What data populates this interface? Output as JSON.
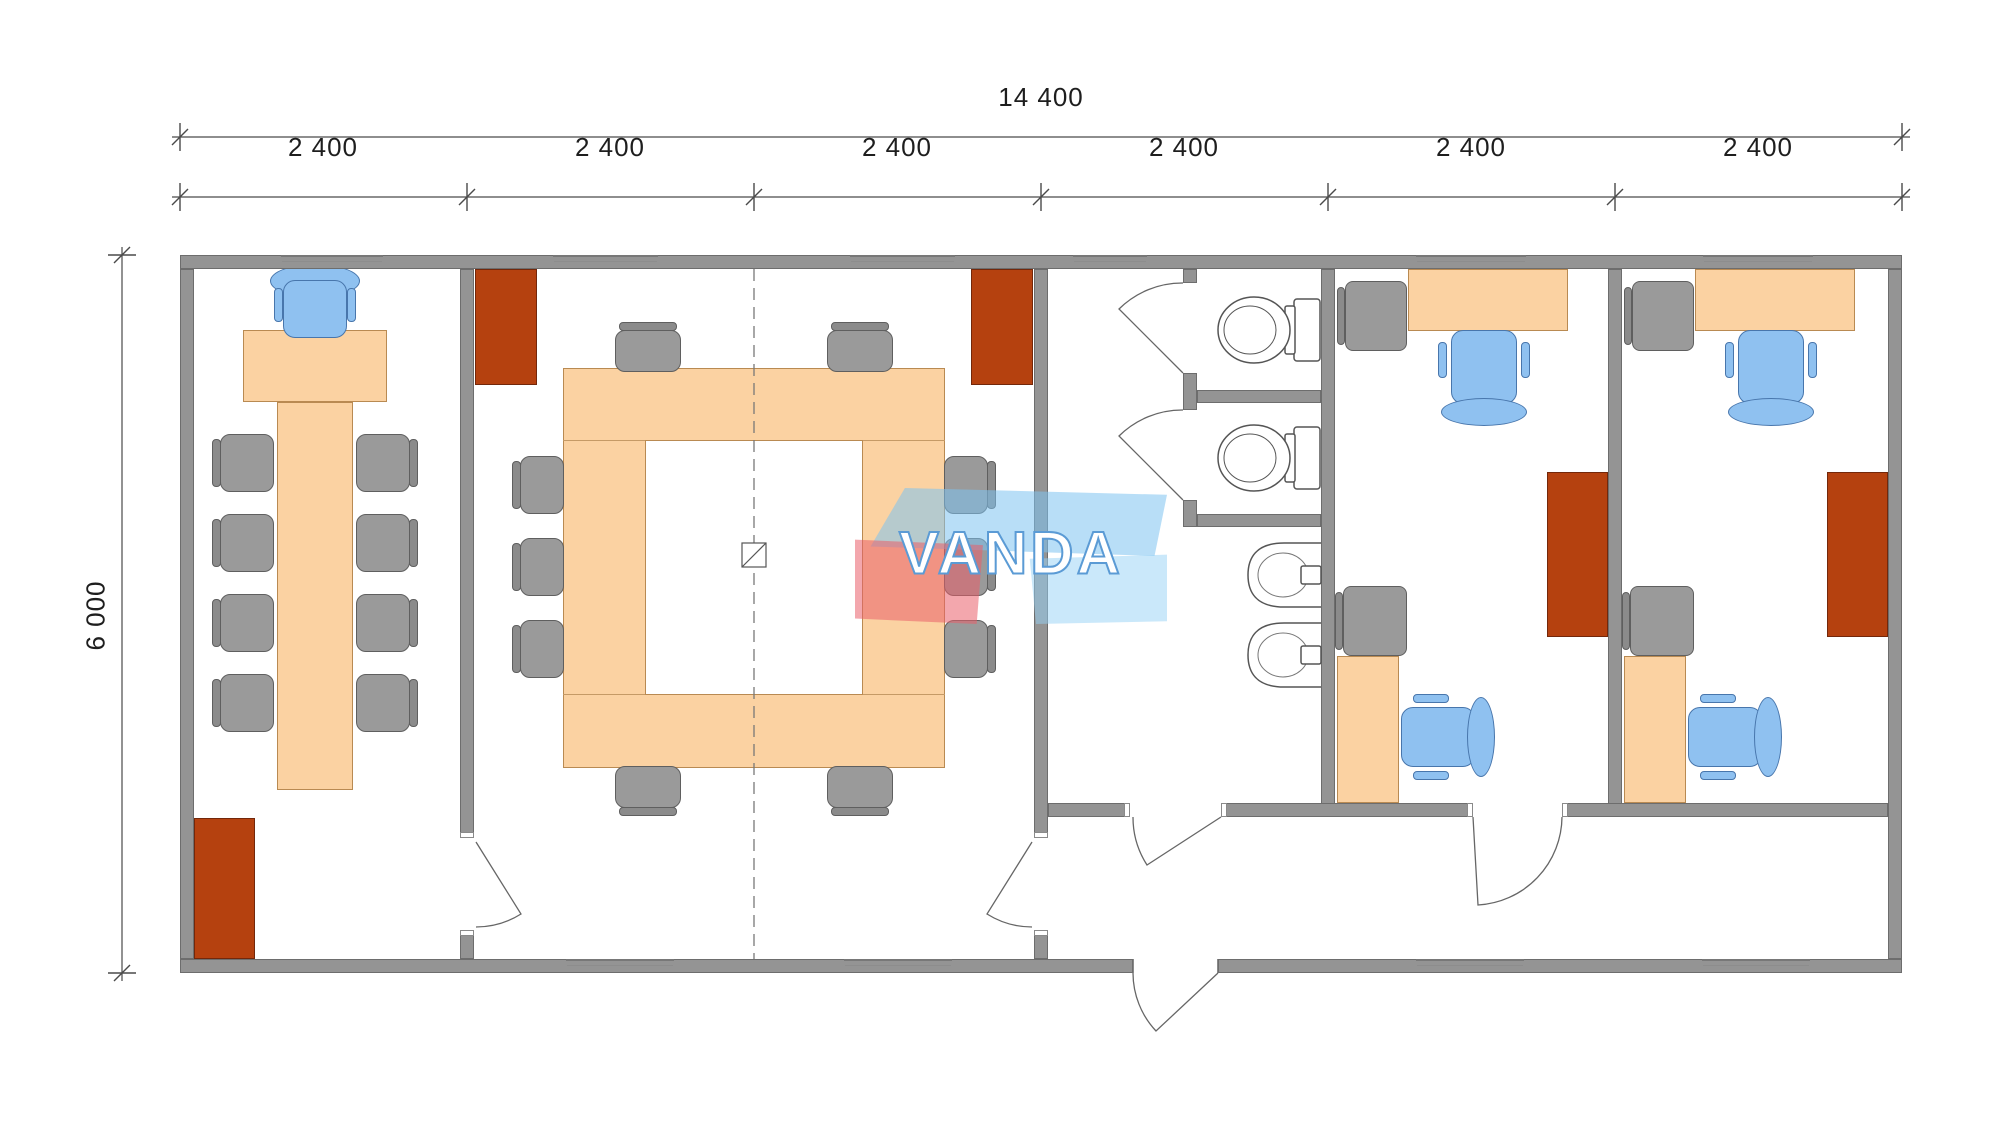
{
  "plan": {
    "dimensions": {
      "total_width_label": "14 400",
      "module_labels": [
        "2 400",
        "2 400",
        "2 400",
        "2 400",
        "2 400",
        "2 400"
      ],
      "total_height_label": "6 000"
    },
    "watermark": {
      "text": "VANDA"
    },
    "colors": {
      "wall_gray": "#949494",
      "desk_orange": "#fbd2a2",
      "cabinet_red": "#b5410f",
      "chair_blue": "#8fc1f0",
      "chair_gray": "#9a9a9a"
    }
  }
}
